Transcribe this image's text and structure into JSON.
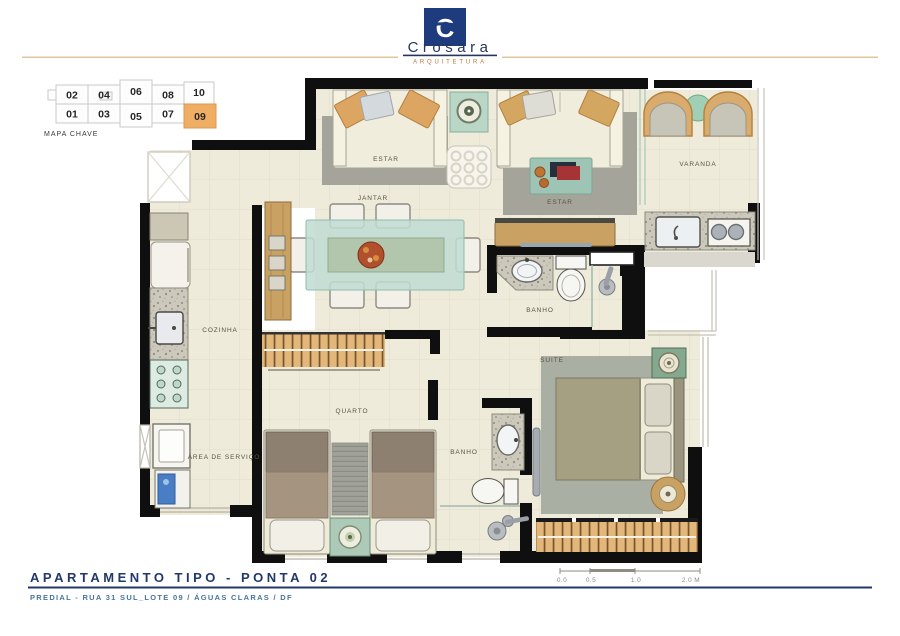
{
  "header": {
    "brand": "Crosara",
    "brand_tagline": "ARQUITETURA",
    "monogram": "C"
  },
  "key_map": {
    "caption": "MAPA CHAVE",
    "top_row": [
      "02",
      "04",
      "06",
      "08",
      "10"
    ],
    "bottom_row": [
      "01",
      "03",
      "05",
      "07",
      "09"
    ],
    "highlighted_unit": "09",
    "highlight_color": "#EFAE63"
  },
  "rooms": {
    "estar_left": "ESTAR",
    "estar_right": "ESTAR",
    "jantar": "JANTAR",
    "varanda": "VARANDA",
    "cozinha": "COZINHA",
    "area_servico": "ÁREA DE SERVIÇO",
    "banho_social": "BANHO",
    "banho_suite": "BANHO",
    "quarto": "QUARTO",
    "suite": "SUITE"
  },
  "scale_bar": {
    "labels": [
      "0.0",
      "0.5",
      "1.0",
      "2.0 M"
    ]
  },
  "footer": {
    "title": "APARTAMENTO TIPO - PONTA 02",
    "subtitle": "PREDIAL - RUA 31 SUL_LOTE 09 / ÁGUAS CLARAS / DF"
  },
  "colors": {
    "brand_navy": "#21386B",
    "brand_orange": "#C0763B",
    "unit_highlight": "#EFAE63",
    "wall": "#0F0F0F",
    "floor": "#EFEBDA",
    "rug": "#A5A49A",
    "wood": "#C9A263",
    "accent_teal": "#A9CDBD"
  }
}
